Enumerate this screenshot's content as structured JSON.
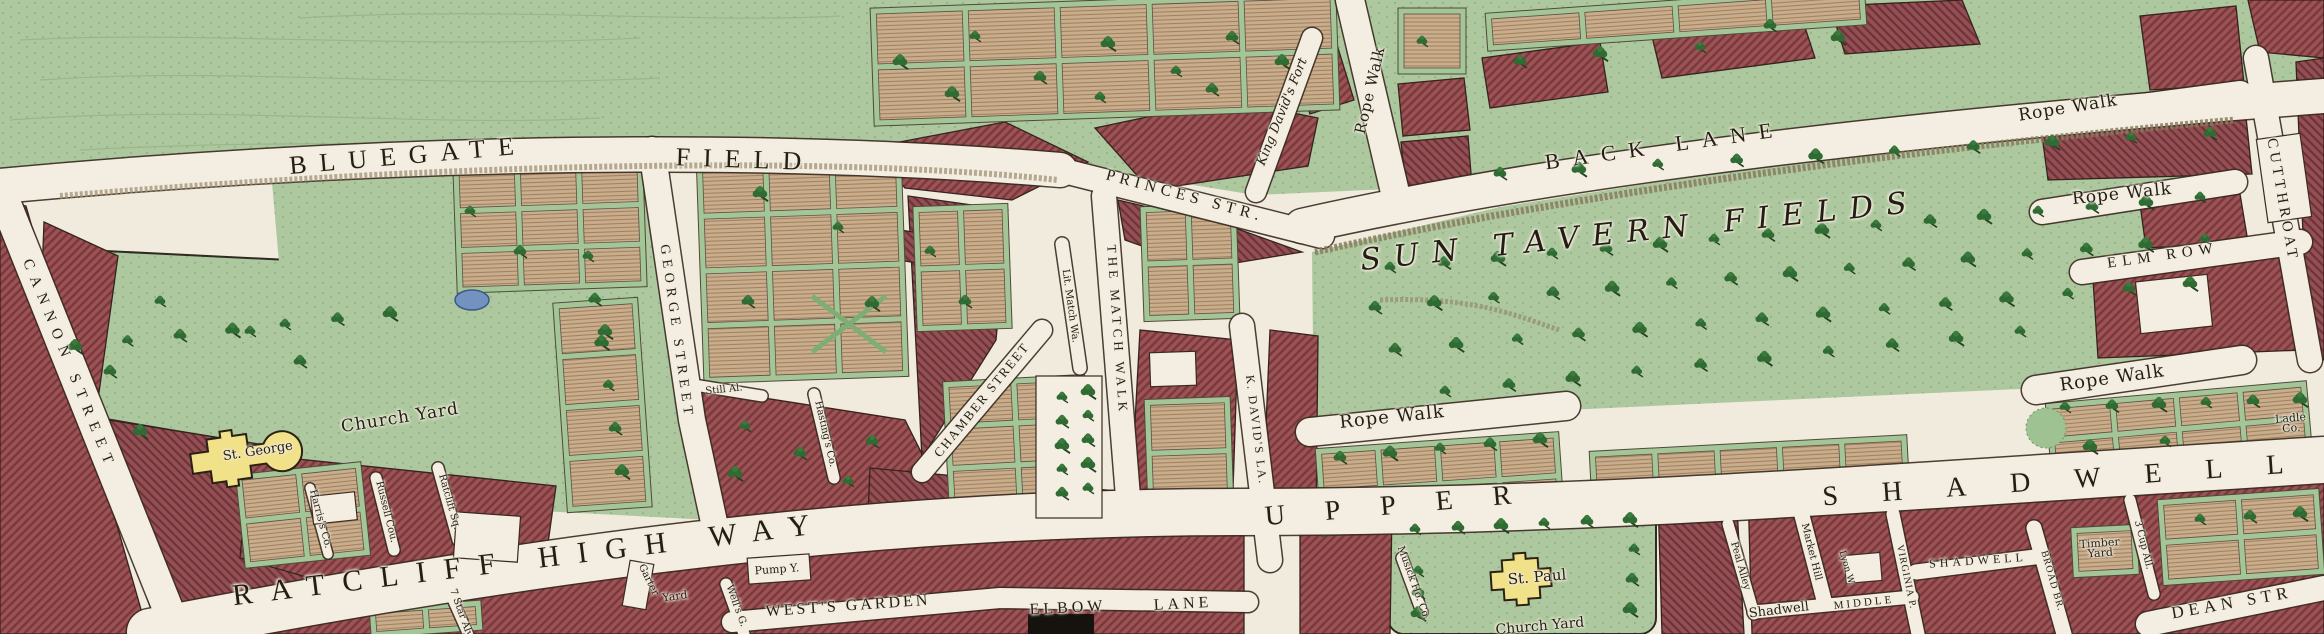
{
  "map": {
    "kind": "engraved-historical-town-map",
    "churches": [
      "St. George",
      "St. Paul"
    ],
    "features": [
      "pond",
      "tree rows",
      "rope walks",
      "garden plots"
    ]
  },
  "palette": {
    "paper": "#f0ebdd",
    "field_green": "#adc89e",
    "block_red": "#9b5355",
    "plot_tan": "#c9ae8e",
    "church_yellow": "#f1e189",
    "water_blue": "#7392c0",
    "tree_green": "#2f6b33",
    "ink": "#241d14"
  },
  "labels": [
    {
      "id": "bluegate",
      "text": "BLUEGATE",
      "x": 408,
      "y": 156,
      "rot": -5,
      "fs": 26,
      "ls": 13,
      "cls": "street"
    },
    {
      "id": "field",
      "text": "FIELD",
      "x": 745,
      "y": 160,
      "rot": 2,
      "fs": 26,
      "ls": 13,
      "cls": "street"
    },
    {
      "id": "princes-str",
      "text": "PRINCES STR.",
      "x": 1185,
      "y": 196,
      "rot": 15,
      "fs": 16,
      "ls": 5,
      "cls": "street"
    },
    {
      "id": "back-lane",
      "text": "BACK LANE",
      "x": 1665,
      "y": 146,
      "rot": -8,
      "fs": 22,
      "ls": 13,
      "cls": "street"
    },
    {
      "id": "rope-walk-top",
      "text": "Rope Walk",
      "x": 2068,
      "y": 108,
      "rot": -9,
      "fs": 17,
      "ls": 1,
      "cls": "name"
    },
    {
      "id": "rope-walk-mid",
      "text": "Rope Walk",
      "x": 2122,
      "y": 194,
      "rot": -6,
      "fs": 17,
      "ls": 1,
      "cls": "name"
    },
    {
      "id": "elm-row",
      "text": "ELM ROW",
      "x": 2163,
      "y": 256,
      "rot": -8,
      "fs": 15,
      "ls": 6,
      "cls": "street"
    },
    {
      "id": "cutthroat",
      "text": "CUTTHROAT",
      "x": 2282,
      "y": 200,
      "rot": 80,
      "fs": 15,
      "ls": 4,
      "cls": "street"
    },
    {
      "id": "sun-tavern-fields",
      "text": "SUN TAVERN FIELDS",
      "x": 1640,
      "y": 232,
      "rot": -6,
      "fs": 30,
      "ls": 13,
      "cls": "italic"
    },
    {
      "id": "rope-walk-center",
      "text": "Rope Walk",
      "x": 1392,
      "y": 417,
      "rot": -6,
      "fs": 18,
      "ls": 1,
      "cls": "name"
    },
    {
      "id": "rope-walk-right",
      "text": "Rope Walk",
      "x": 2112,
      "y": 378,
      "rot": -8,
      "fs": 18,
      "ls": 1,
      "cls": "name"
    },
    {
      "id": "ladle-co",
      "text": "Ladle Co.",
      "x": 2291,
      "y": 424,
      "rot": -5,
      "fs": 11,
      "ls": 0,
      "cls": "name",
      "w": 46
    },
    {
      "id": "cannon-street",
      "text": "CANNON STREET",
      "x": 69,
      "y": 365,
      "rot": 68,
      "fs": 15,
      "ls": 8,
      "cls": "street"
    },
    {
      "id": "church-yard",
      "text": "Church Yard",
      "x": 400,
      "y": 418,
      "rot": -9,
      "fs": 17,
      "ls": 1,
      "cls": "name"
    },
    {
      "id": "st-george",
      "text": "St. George",
      "x": 258,
      "y": 452,
      "rot": -9,
      "fs": 13,
      "ls": 0,
      "cls": "name"
    },
    {
      "id": "george-street",
      "text": "GEORGE STREET",
      "x": 676,
      "y": 332,
      "rot": 82,
      "fs": 14,
      "ls": 5,
      "cls": "street"
    },
    {
      "id": "chamber-street",
      "text": "CHAMBER STREET",
      "x": 982,
      "y": 400,
      "rot": -51,
      "fs": 13,
      "ls": 2,
      "cls": "street"
    },
    {
      "id": "the-match-walk",
      "text": "THE MATCH WALK",
      "x": 1117,
      "y": 330,
      "rot": 86,
      "fs": 13,
      "ls": 4,
      "cls": "street"
    },
    {
      "id": "lit-match-wa",
      "text": "Lit. Match Wa.",
      "x": 1070,
      "y": 306,
      "rot": 82,
      "fs": 10,
      "ls": 0,
      "cls": "name"
    },
    {
      "id": "k-davids-la",
      "text": "K. DAVID'S LA.",
      "x": 1256,
      "y": 430,
      "rot": 83,
      "fs": 12,
      "ls": 2,
      "cls": "street"
    },
    {
      "id": "king-davids-fort",
      "text": "King David's Fort",
      "x": 1283,
      "y": 112,
      "rot": -68,
      "fs": 13,
      "ls": 0,
      "cls": "italic"
    },
    {
      "id": "rope-walk-vertical",
      "text": "Rope Walk",
      "x": 1370,
      "y": 90,
      "rot": -77,
      "fs": 15,
      "ls": 1,
      "cls": "name"
    },
    {
      "id": "ratcliff-high-way",
      "text": "RATCLIFF HIGH WAY",
      "x": 530,
      "y": 560,
      "rot": -7,
      "fs": 30,
      "ls": 18,
      "cls": "street"
    },
    {
      "id": "upper",
      "text": "UPPER",
      "x": 1408,
      "y": 505,
      "rot": -5,
      "fs": 28,
      "ls": 40,
      "cls": "street"
    },
    {
      "id": "shadwell-big",
      "text": "SHADWELL",
      "x": 2075,
      "y": 480,
      "rot": -4,
      "fs": 28,
      "ls": 44,
      "cls": "street"
    },
    {
      "id": "wests-garden",
      "text": "WEST'S GARDEN",
      "x": 848,
      "y": 606,
      "rot": -4,
      "fs": 16,
      "ls": 3,
      "cls": "street"
    },
    {
      "id": "elbow",
      "text": "ELBOW",
      "x": 1068,
      "y": 608,
      "rot": -3,
      "fs": 16,
      "ls": 4,
      "cls": "street"
    },
    {
      "id": "lane",
      "text": "LANE",
      "x": 1183,
      "y": 604,
      "rot": -3,
      "fs": 16,
      "ls": 4,
      "cls": "street"
    },
    {
      "id": "pump-y",
      "text": "Pump Y.",
      "x": 777,
      "y": 570,
      "rot": -4,
      "fs": 11,
      "ls": 0,
      "cls": "name"
    },
    {
      "id": "wells-g",
      "text": "Well's G.",
      "x": 736,
      "y": 606,
      "rot": 70,
      "fs": 10,
      "ls": 0,
      "cls": "name"
    },
    {
      "id": "garter",
      "text": "Garter",
      "x": 648,
      "y": 580,
      "rot": 64,
      "fs": 10,
      "ls": 0,
      "cls": "name"
    },
    {
      "id": "yard",
      "text": "Yard",
      "x": 675,
      "y": 597,
      "rot": -8,
      "fs": 11,
      "ls": 0,
      "cls": "name"
    },
    {
      "id": "seven-star-aly",
      "text": "7 Star Aly.",
      "x": 461,
      "y": 614,
      "rot": 70,
      "fs": 10,
      "ls": 0,
      "cls": "name"
    },
    {
      "id": "still-al",
      "text": "Still Al.",
      "x": 724,
      "y": 390,
      "rot": -6,
      "fs": 10,
      "ls": 0,
      "cls": "name"
    },
    {
      "id": "hastings-co",
      "text": "Hasting's Co.",
      "x": 825,
      "y": 434,
      "rot": 77,
      "fs": 10,
      "ls": 0,
      "cls": "name"
    },
    {
      "id": "harriss-co",
      "text": "Harris's Co.",
      "x": 320,
      "y": 519,
      "rot": 75,
      "fs": 10,
      "ls": 0,
      "cls": "name"
    },
    {
      "id": "russell-cou",
      "text": "Russell Cou.",
      "x": 386,
      "y": 512,
      "rot": 76,
      "fs": 10,
      "ls": 0,
      "cls": "name"
    },
    {
      "id": "ratclift-sq",
      "text": "Ratclift Sq.",
      "x": 449,
      "y": 502,
      "rot": 74,
      "fs": 10,
      "ls": 0,
      "cls": "name"
    },
    {
      "id": "musick-ho-co",
      "text": "Musick Ho. Co.",
      "x": 1413,
      "y": 583,
      "rot": 70,
      "fs": 10,
      "ls": 0,
      "cls": "name"
    },
    {
      "id": "st-paul",
      "text": "St. Paul",
      "x": 1537,
      "y": 577,
      "rot": -5,
      "fs": 15,
      "ls": 0,
      "cls": "name"
    },
    {
      "id": "shadwell-church-yard",
      "text": "Church Yard",
      "x": 1540,
      "y": 627,
      "rot": -5,
      "fs": 14,
      "ls": 0,
      "cls": "name"
    },
    {
      "id": "market-hill",
      "text": "Market Hill",
      "x": 1811,
      "y": 552,
      "rot": 76,
      "fs": 10,
      "ls": 0,
      "cls": "name"
    },
    {
      "id": "peal-alley",
      "text": "Peal Alley",
      "x": 1740,
      "y": 566,
      "rot": 74,
      "fs": 10,
      "ls": 0,
      "cls": "name"
    },
    {
      "id": "shadwell-small",
      "text": "Shadwell",
      "x": 1779,
      "y": 611,
      "rot": -7,
      "fs": 13,
      "ls": 0,
      "cls": "name"
    },
    {
      "id": "middle",
      "text": "MIDDLE",
      "x": 1864,
      "y": 603,
      "rot": -6,
      "fs": 11,
      "ls": 3,
      "cls": "street"
    },
    {
      "id": "lyon-w",
      "text": "Lyon W.",
      "x": 1846,
      "y": 568,
      "rot": 74,
      "fs": 9,
      "ls": 0,
      "cls": "name"
    },
    {
      "id": "virginia-p",
      "text": "VIRGINIA P.",
      "x": 1906,
      "y": 577,
      "rot": 78,
      "fs": 10,
      "ls": 1,
      "cls": "street"
    },
    {
      "id": "shadwell-street",
      "text": "SHADWELL",
      "x": 1978,
      "y": 561,
      "rot": -4,
      "fs": 12,
      "ls": 4,
      "cls": "street"
    },
    {
      "id": "broad-br",
      "text": "BROAD BR.",
      "x": 2052,
      "y": 581,
      "rot": 74,
      "fs": 10,
      "ls": 1,
      "cls": "street"
    },
    {
      "id": "timber-yard",
      "text": "Timber Yard",
      "x": 2100,
      "y": 549,
      "rot": -4,
      "fs": 11,
      "ls": 0,
      "cls": "name",
      "w": 54
    },
    {
      "id": "three-cup-all",
      "text": "3 Cup All.",
      "x": 2143,
      "y": 545,
      "rot": 76,
      "fs": 10,
      "ls": 0,
      "cls": "name"
    },
    {
      "id": "dean-str",
      "text": "DEAN STR",
      "x": 2232,
      "y": 603,
      "rot": -10,
      "fs": 17,
      "ls": 5,
      "cls": "street"
    }
  ]
}
